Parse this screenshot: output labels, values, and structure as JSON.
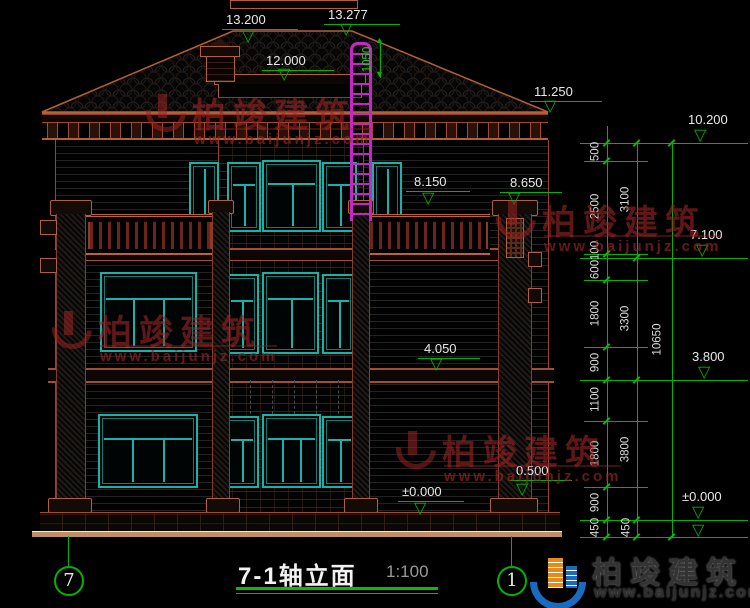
{
  "title": {
    "text": "7-1轴立面",
    "scale": "1:100"
  },
  "axis_bubbles": {
    "left": "7",
    "right": "1"
  },
  "levels": {
    "l13200": "13.200",
    "l13277": "13.277",
    "l12000": "12.000",
    "l11250": "11.250",
    "l8650": "8.650",
    "l8150": "8.150",
    "l4050": "4.050",
    "l0000": "±0.000",
    "l0500": "0.500"
  },
  "right_levels": {
    "l10200": "10.200",
    "l7100": "7.100",
    "l3800": "3.800",
    "l0000": "±0.000"
  },
  "dims": {
    "ladder_height": "1050",
    "chain1": [
      "500",
      "2500",
      "100",
      "600",
      "1800",
      "900",
      "1100",
      "1800",
      "900",
      "450"
    ],
    "chain2": [
      "3100",
      "3300",
      "3800",
      "450"
    ],
    "chain3": [
      "10650"
    ]
  },
  "watermark": {
    "name": "柏竣建筑",
    "url": "www.baijunjz.com"
  },
  "logo": {
    "name": "柏竣建筑",
    "url": "www.baijunjz.com"
  },
  "colors": {
    "annotation_green": "#00b400",
    "window_cyan": "#18b2a8",
    "outline_brown": "#b0603a",
    "ladder_magenta": "#c428c4",
    "watermark_red": "#9e2424",
    "logo_blue": "#1a6abf",
    "logo_orange": "#e88a1a"
  }
}
